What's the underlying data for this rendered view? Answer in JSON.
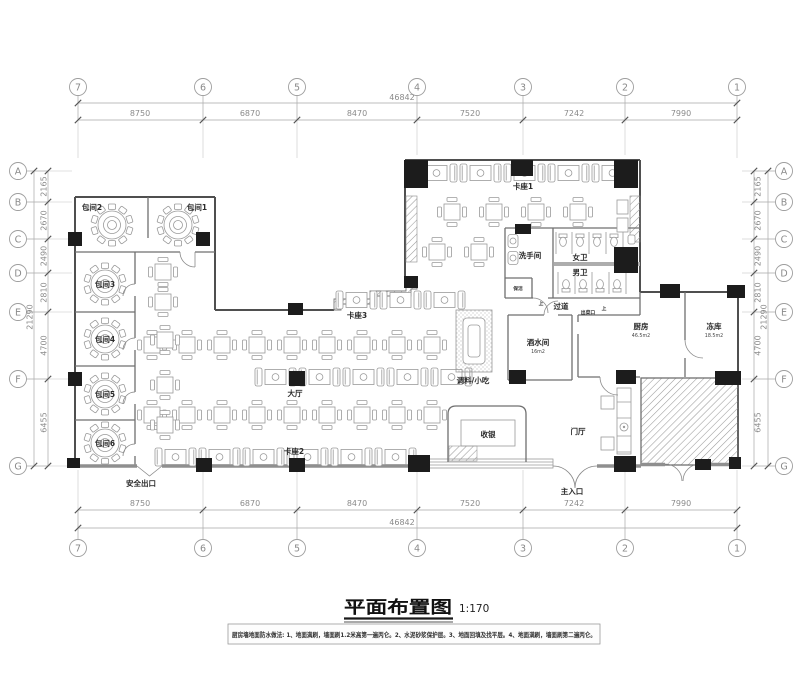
{
  "drawing": {
    "title": "平面布置图",
    "scale": "1:170",
    "note": "厨房墙地面防水做法: 1、地面满刷，墙面刷1.2米高第一遍丙仑。2、水泥砂浆保护层。3、地面回填及找平层。4、地面满刷，墙面刷第二遍丙仑。"
  },
  "grid": {
    "cols": [
      "7",
      "6",
      "5",
      "4",
      "3",
      "2",
      "1"
    ],
    "rows": [
      "A",
      "B",
      "C",
      "D",
      "E",
      "F",
      "G"
    ],
    "col_dims": [
      "8750",
      "6870",
      "8470",
      "7520",
      "7242",
      "7990"
    ],
    "col_total": "46842",
    "row_dims": [
      "2165",
      "2670",
      "2490",
      "2810",
      "4700",
      "6455"
    ],
    "row_total": "21290"
  },
  "rooms": {
    "private1": "包间1",
    "private2": "包间2",
    "private3": "包间3",
    "private4": "包间4",
    "private5": "包间5",
    "private6": "包间6",
    "booth1": "卡座1",
    "booth2": "卡座2",
    "booth3": "卡座3",
    "hall": "大厅",
    "foyer": "门厅",
    "cashier": "收银",
    "condiments": "调料/小吃",
    "kitchen": "厨房",
    "kitchen_area": "46.5m2",
    "freezer": "冻库",
    "freezer_area": "18.5m2",
    "beverage": "酒水间",
    "beverage_area": "16m2",
    "washroom": "洗手间",
    "women_wc": "女卫",
    "men_wc": "男卫",
    "cleaning": "保洁",
    "corridor": "过道",
    "serving_hatch": "出菜口",
    "up": "上",
    "main_entrance": "主入口",
    "safety_exit": "安全出口"
  }
}
